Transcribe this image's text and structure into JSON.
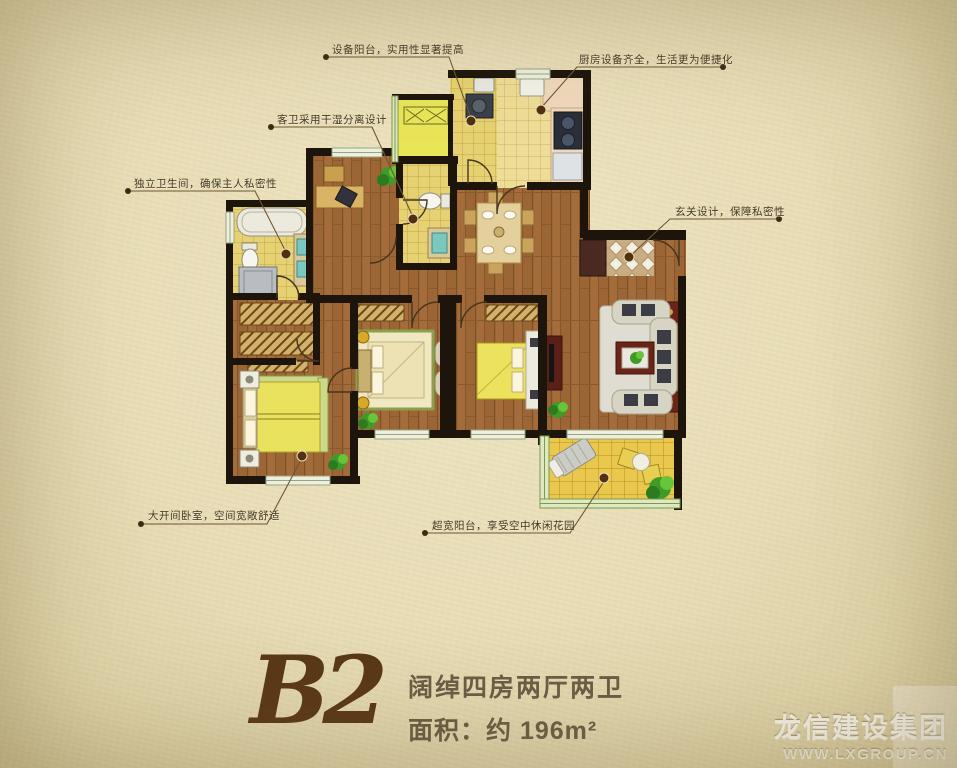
{
  "title": {
    "unit": "B2",
    "desc": "阔绰四房两厅两卫",
    "area": "面积：约 196m²"
  },
  "annotations": [
    {
      "id": "equipment-balcony",
      "text": "设备阳台，实用性显著提高"
    },
    {
      "id": "kitchen",
      "text": "厨房设备齐全，生活更为便捷化"
    },
    {
      "id": "guest-bath",
      "text": "客卫采用干湿分离设计"
    },
    {
      "id": "master-bath",
      "text": "独立卫生间，确保主人私密性"
    },
    {
      "id": "entry",
      "text": "玄关设计，保障私密性"
    },
    {
      "id": "master-bedroom",
      "text": "大开间卧室，空间宽敞舒适"
    },
    {
      "id": "balcony",
      "text": "超宽阳台，享受空中休闲花园"
    }
  ],
  "watermark": {
    "company": "龙信建设集团",
    "website": "WWW.LXGROUP.CN"
  },
  "colors": {
    "background": "#e8ddb6",
    "wall": "#1d150c",
    "wood_floor": "#a36c3a",
    "tile": "#e6d272",
    "balcony_tile": "#eac84d",
    "title_brown": "#5a3817",
    "annotation_text": "#43361e",
    "watermark_white": "#fdfbf3"
  }
}
